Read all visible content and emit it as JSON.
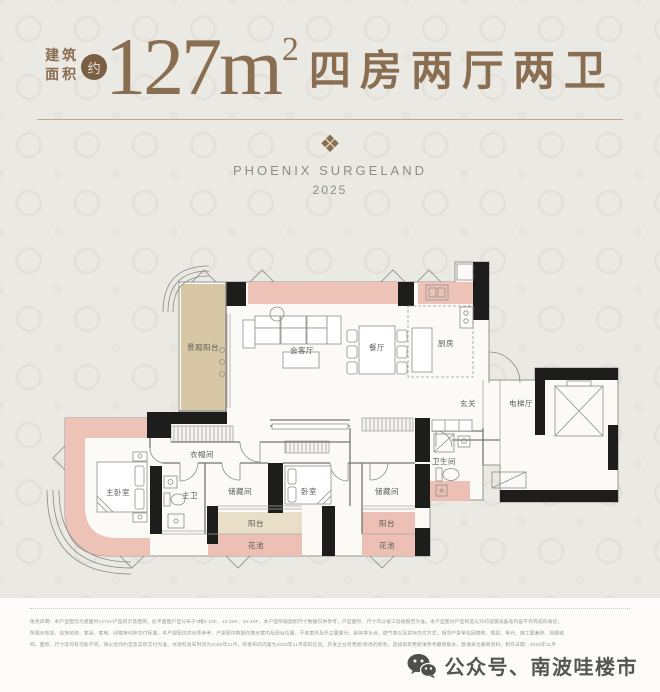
{
  "colors": {
    "accent": "#8a6e52",
    "badge": "#7a5f45",
    "brand": "#8f8c85",
    "pink": "#edc3b8",
    "pink2": "#ecc0b4",
    "tan": "#d8c7a5"
  },
  "header": {
    "area_label_top": "建筑",
    "area_label_bottom": "面积",
    "approx": "约",
    "area_number": "127m",
    "area_exponent": "2",
    "rooms_text": "四房两厅两卫"
  },
  "brand": {
    "icon": "❖",
    "name": "PHOENIX SURGELAND",
    "year": "2025"
  },
  "floorplan": {
    "rooms": {
      "landscape_balcony": "景观阳台",
      "living_room": "会客厅",
      "dining_room": "餐厅",
      "kitchen": "厨房",
      "foyer": "玄关",
      "elevator_hall": "电梯厅",
      "cloakroom": "衣帽间",
      "master_bedroom": "主卧室",
      "master_bathroom": "主卫",
      "storage_left": "储藏间",
      "bedroom": "卧室",
      "balcony_left": "阳台",
      "flower_bed_left": "花池",
      "bathroom": "卫生间",
      "storage_right": "储藏间",
      "balcony_right": "阳台",
      "flower_bed_right": "花池"
    }
  },
  "disclaimer": {
    "line1": "免责声明：本户型图仅为建面约127m²户型的示意图例，此平面图户型分布于3幢2-10F、12-26F、26-40F，本户型所载面积尺寸数据仅供参考，户型面积、尺寸均以竣工验收报告为准，本户型图对户型构造以外的设施设备等内容不作完成的表达，",
    "line2": "所展示软装、装饰装修、家具、家电、绿植等均非交付标准，本户型图仅供示意参考，户型图中数据仅表示室内及阳台位置，不含室外及外立面部分，具体排水点、燃气表以及实际交付方式，相邻户型单位因楼栋、楼层、单元、施工图差异、局部结",
    "line3": "构、面积、尺寸等均有可能不同，请以合同约定及实际交付为准。本资料发布时间为2025年11月，所发布的内容为2025年11月前的信息，开发企业有更新/修改的权利，后续如有更新请参考最新版本，敬请关注最新资料。制作日期：2025年11月"
  },
  "footer": {
    "account_label": "公众号、南波哇楼市"
  }
}
